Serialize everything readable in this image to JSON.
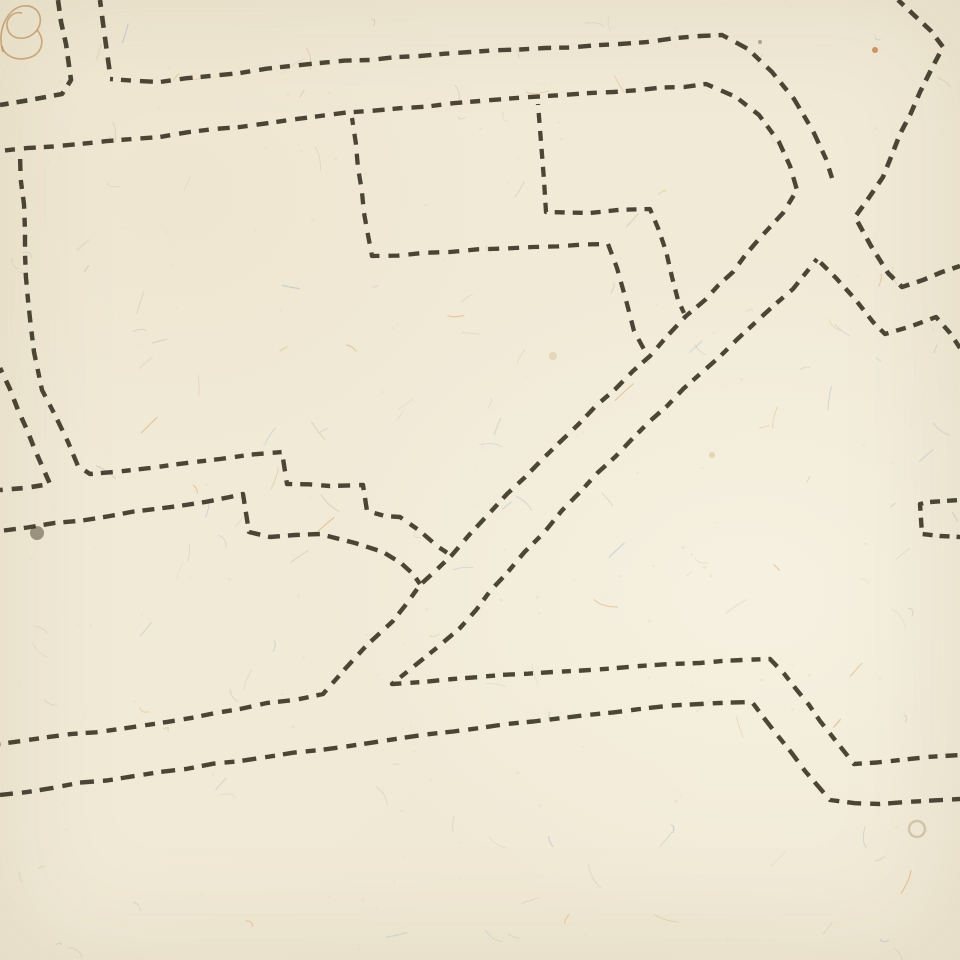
{
  "canvas": {
    "width": 960,
    "height": 960
  },
  "paper": {
    "base_color": "#f1ead7",
    "shade_color": "#e6dcc2",
    "texture_seed": 11,
    "fiber_count": 150,
    "speck_count": 230,
    "fiber_colors": {
      "blue": "#a9bdcb",
      "orange": "#d7a661",
      "dark": "#cdc2a6"
    }
  },
  "ink": {
    "color": "#3a3323",
    "opacity": 0.9,
    "default_width": 4.4,
    "default_dash": [
      12,
      8
    ]
  },
  "marginalia": {
    "curlicue_color": "#bd8d5b",
    "curlicue_paths": [
      "M 3,52 C -4,30 8,8 23,6 C 38,4 45,19 37,30 C 29,41 12,41 8,30 C 4,19 13,11 22,13",
      "M 37,30 C 46,40 42,55 28,58 C 16,61 4,56 2,46"
    ]
  },
  "stains": [
    {
      "x": 37,
      "y": 533,
      "r": 7,
      "fill": "#4a3d28",
      "opacity": 0.5,
      "ring": false
    },
    {
      "x": 917,
      "y": 829,
      "r": 8,
      "fill": "#8b7a4e",
      "opacity": 0.3,
      "ring": true
    },
    {
      "x": 875,
      "y": 50,
      "r": 3,
      "fill": "#c1773a",
      "opacity": 0.75,
      "ring": false
    },
    {
      "x": 553,
      "y": 356,
      "r": 4,
      "fill": "#d8c49a",
      "opacity": 0.5,
      "ring": false
    },
    {
      "x": 712,
      "y": 455,
      "r": 3,
      "fill": "#d8b98a",
      "opacity": 0.5,
      "ring": false
    },
    {
      "x": 760,
      "y": 42,
      "r": 2,
      "fill": "#6b5d3f",
      "opacity": 0.5,
      "ring": false
    }
  ],
  "lines": [
    {
      "name": "top-left-outer-corner",
      "points": [
        [
          58,
          0
        ],
        [
          66,
          44
        ],
        [
          71,
          80
        ],
        [
          62,
          94
        ],
        [
          30,
          100
        ],
        [
          0,
          105
        ]
      ],
      "dash": [
        11,
        8
      ],
      "width": 4.6
    },
    {
      "name": "top-left-inner-vertical",
      "points": [
        [
          100,
          0
        ],
        [
          106,
          45
        ],
        [
          110,
          74
        ]
      ],
      "dash": [
        12,
        9
      ],
      "width": 4.6
    },
    {
      "name": "top-street-upper-line",
      "points": [
        [
          110,
          79
        ],
        [
          160,
          82
        ],
        [
          240,
          73
        ],
        [
          320,
          63
        ],
        [
          470,
          52
        ],
        [
          620,
          44
        ],
        [
          700,
          36
        ],
        [
          722,
          35
        ],
        [
          748,
          49
        ],
        [
          772,
          72
        ],
        [
          794,
          99
        ],
        [
          813,
          131
        ],
        [
          826,
          159
        ],
        [
          832,
          178
        ]
      ],
      "dash": [
        13,
        8,
        10,
        9
      ],
      "width": 4.4
    },
    {
      "name": "top-street-lower-line-and-main-diagonal",
      "points": [
        [
          0,
          151
        ],
        [
          80,
          144
        ],
        [
          160,
          137
        ],
        [
          320,
          116
        ],
        [
          480,
          101
        ],
        [
          640,
          90
        ],
        [
          706,
          84
        ],
        [
          736,
          97
        ],
        [
          759,
          115
        ],
        [
          779,
          142
        ],
        [
          790,
          166
        ],
        [
          797,
          190
        ],
        [
          783,
          213
        ],
        [
          759,
          239
        ],
        [
          733,
          272
        ],
        [
          705,
          300
        ],
        [
          686,
          316
        ],
        [
          650,
          356
        ],
        [
          633,
          371
        ],
        [
          560,
          442
        ],
        [
          507,
          494
        ],
        [
          452,
          555
        ],
        [
          420,
          585
        ],
        [
          393,
          621
        ],
        [
          367,
          645
        ],
        [
          345,
          669
        ],
        [
          323,
          694
        ],
        [
          240,
          709
        ],
        [
          120,
          729
        ],
        [
          0,
          744
        ]
      ],
      "dash": [
        12,
        8,
        10,
        9
      ],
      "width": 4.4
    },
    {
      "name": "northeast-zigzag",
      "points": [
        [
          898,
          0
        ],
        [
          915,
          16
        ],
        [
          931,
          31
        ],
        [
          943,
          47
        ],
        [
          920,
          92
        ],
        [
          900,
          134
        ],
        [
          883,
          177
        ],
        [
          868,
          199
        ],
        [
          855,
          217
        ],
        [
          871,
          246
        ],
        [
          888,
          273
        ],
        [
          902,
          287
        ],
        [
          923,
          280
        ],
        [
          942,
          272
        ],
        [
          960,
          266
        ]
      ],
      "dash": [
        11,
        8
      ],
      "width": 4.6
    },
    {
      "name": "diagonal-road-lower-line-and-bottom-upper-road",
      "points": [
        [
          817,
          259
        ],
        [
          793,
          289
        ],
        [
          757,
          321
        ],
        [
          700,
          374
        ],
        [
          650,
          421
        ],
        [
          581,
          491
        ],
        [
          507,
          573
        ],
        [
          460,
          628
        ],
        [
          392,
          684
        ],
        [
          453,
          679
        ],
        [
          553,
          672
        ],
        [
          640,
          666
        ],
        [
          700,
          663
        ],
        [
          770,
          659
        ],
        [
          796,
          689
        ],
        [
          820,
          721
        ],
        [
          843,
          750
        ],
        [
          854,
          764
        ],
        [
          900,
          760
        ],
        [
          960,
          755
        ]
      ],
      "dash": [
        12,
        9,
        9,
        8
      ],
      "width": 4.4
    },
    {
      "name": "peak-right-arm-zigzag",
      "points": [
        [
          817,
          259
        ],
        [
          836,
          278
        ],
        [
          855,
          299
        ],
        [
          873,
          322
        ],
        [
          885,
          334
        ],
        [
          912,
          326
        ],
        [
          936,
          317
        ],
        [
          950,
          333
        ],
        [
          960,
          348
        ]
      ],
      "dash": [
        10,
        8
      ],
      "width": 4.4
    },
    {
      "name": "bottom-lower-road",
      "points": [
        [
          0,
          795
        ],
        [
          160,
          772
        ],
        [
          320,
          750
        ],
        [
          480,
          728
        ],
        [
          640,
          709
        ],
        [
          700,
          704
        ],
        [
          752,
          702
        ],
        [
          778,
          736
        ],
        [
          805,
          771
        ],
        [
          830,
          800
        ],
        [
          880,
          804
        ],
        [
          960,
          799
        ]
      ],
      "dash": [
        14,
        9,
        10,
        8
      ],
      "width": 4.4
    },
    {
      "name": "left-street-outer-corner",
      "points": [
        [
          0,
          368
        ],
        [
          18,
          410
        ],
        [
          35,
          450
        ],
        [
          50,
          484
        ],
        [
          25,
          488
        ],
        [
          0,
          490
        ]
      ],
      "dash": [
        11,
        9
      ],
      "width": 4.6
    },
    {
      "name": "left-long-line-with-steps",
      "points": [
        [
          20,
          153
        ],
        [
          25,
          230
        ],
        [
          28,
          300
        ],
        [
          34,
          352
        ],
        [
          42,
          390
        ],
        [
          55,
          415
        ],
        [
          68,
          442
        ],
        [
          78,
          466
        ],
        [
          90,
          474
        ],
        [
          150,
          468
        ],
        [
          220,
          459
        ],
        [
          282,
          452
        ],
        [
          287,
          484
        ],
        [
          330,
          486
        ],
        [
          363,
          485
        ],
        [
          367,
          511
        ],
        [
          385,
          516
        ],
        [
          400,
          517
        ],
        [
          420,
          531
        ],
        [
          437,
          546
        ],
        [
          452,
          556
        ]
      ],
      "dash": [
        9,
        8,
        12,
        9
      ],
      "width": 4.4
    },
    {
      "name": "stepped-lower-line",
      "points": [
        [
          0,
          531
        ],
        [
          110,
          516
        ],
        [
          230,
          497
        ],
        [
          243,
          494
        ],
        [
          249,
          532
        ],
        [
          270,
          537
        ],
        [
          320,
          534
        ],
        [
          355,
          543
        ],
        [
          383,
          552
        ],
        [
          401,
          563
        ],
        [
          413,
          574
        ],
        [
          420,
          584
        ]
      ],
      "dash": [
        12,
        8
      ],
      "width": 4.4
    },
    {
      "name": "center-block-outline",
      "points": [
        [
          352,
          118
        ],
        [
          358,
          168
        ],
        [
          364,
          213
        ],
        [
          372,
          256
        ],
        [
          450,
          252
        ],
        [
          533,
          247
        ],
        [
          608,
          244
        ],
        [
          617,
          268
        ],
        [
          626,
          300
        ],
        [
          634,
          331
        ],
        [
          646,
          353
        ]
      ],
      "dash": [
        11,
        9
      ],
      "width": 4.3
    },
    {
      "name": "center-branch-outline",
      "points": [
        [
          538,
          104
        ],
        [
          541,
          142
        ],
        [
          544,
          180
        ],
        [
          546,
          212
        ],
        [
          590,
          213
        ],
        [
          650,
          209
        ],
        [
          658,
          228
        ],
        [
          666,
          251
        ],
        [
          672,
          277
        ],
        [
          678,
          300
        ],
        [
          684,
          313
        ]
      ],
      "dash": [
        10,
        8
      ],
      "width": 4.3
    },
    {
      "name": "right-edge-bracket",
      "points": [
        [
          960,
          500
        ],
        [
          930,
          502
        ],
        [
          920,
          504
        ],
        [
          922,
          534
        ],
        [
          940,
          536
        ],
        [
          960,
          537
        ]
      ],
      "dash": [
        10,
        7
      ],
      "width": 4.4
    }
  ]
}
